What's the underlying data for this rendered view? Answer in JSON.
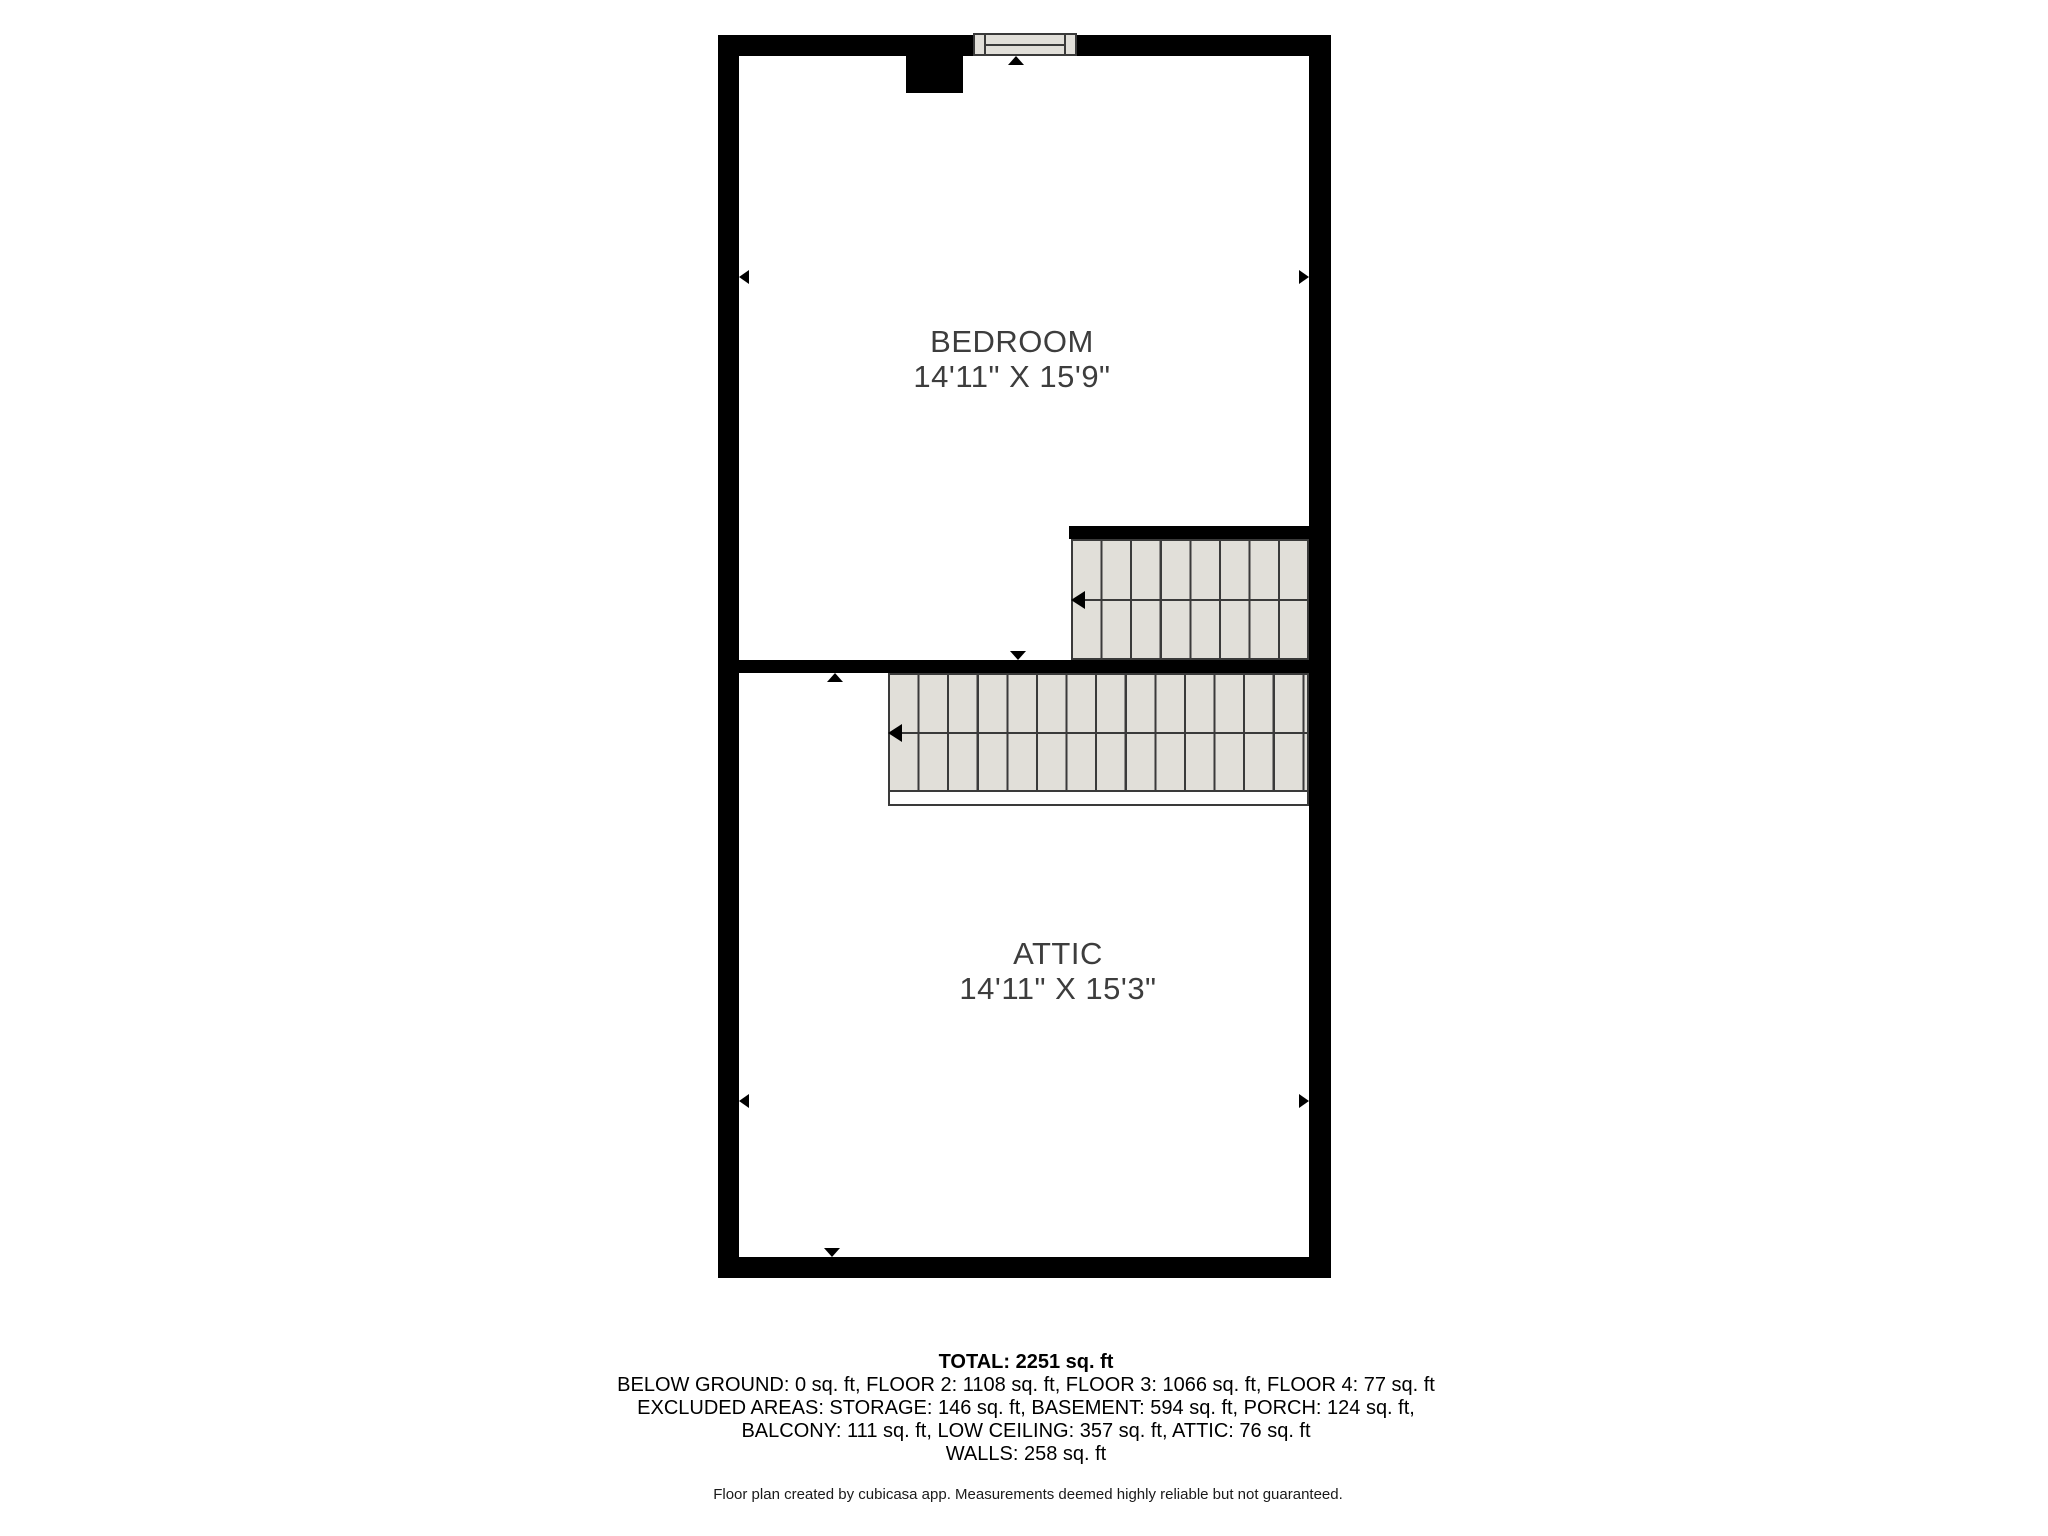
{
  "rooms": [
    {
      "name": "BEDROOM",
      "dimensions": "14'11\" X 15'9\""
    },
    {
      "name": "ATTIC",
      "dimensions": "14'11\" X 15'3\""
    }
  ],
  "summary": {
    "total": "TOTAL: 2251 sq. ft",
    "line1": "BELOW GROUND: 0 sq. ft, FLOOR 2: 1108 sq. ft, FLOOR 3: 1066 sq. ft, FLOOR 4: 77 sq. ft",
    "line2": "EXCLUDED AREAS: STORAGE: 146 sq. ft, BASEMENT: 594 sq. ft, PORCH: 124 sq. ft,",
    "line3": "BALCONY: 111 sq. ft, LOW CEILING: 357 sq. ft, ATTIC: 76 sq. ft",
    "line4": "WALLS: 258 sq. ft"
  },
  "footer": "Floor plan created by cubicasa app. Measurements deemed highly reliable but not guaranteed.",
  "colors": {
    "wall": "#000000",
    "stair_fill": "#e1dfd9",
    "stair_line": "#3a3a3a",
    "label_text": "#3d3d3d",
    "summary_text": "#000000"
  }
}
